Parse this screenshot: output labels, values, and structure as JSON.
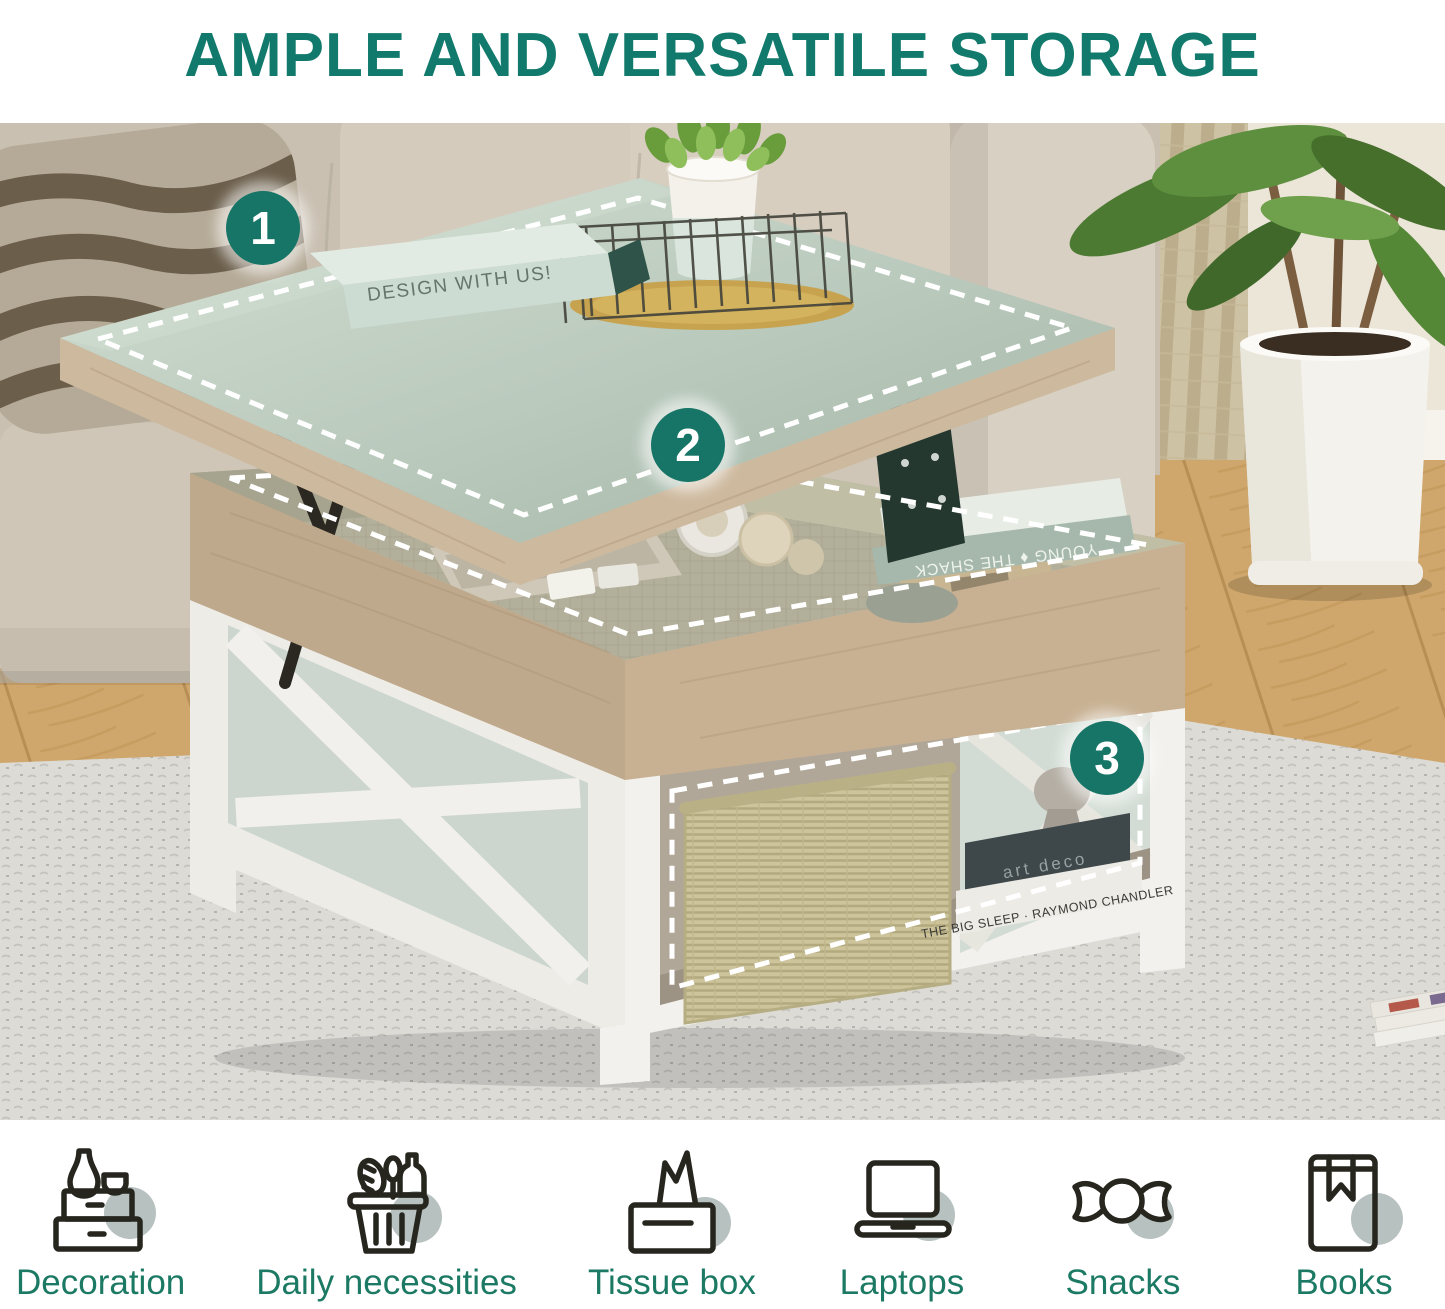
{
  "title": {
    "text": "AMPLE AND VERSATILE STORAGE"
  },
  "photo": {
    "badges": [
      {
        "number": "1"
      },
      {
        "number": "2"
      },
      {
        "number": "3"
      }
    ],
    "tabletop_book_spine": "DESIGN WITH US!",
    "storage_book_spine": "YOUNG ♦ THE SHACK",
    "shelf_book_dark_spine": "art deco",
    "shelf_book_light_spine": "THE BIG SLEEP · RAYMOND CHANDLER"
  },
  "features": [
    {
      "label": "Decoration",
      "icon": "decoration-chest-icon"
    },
    {
      "label": "Daily necessities",
      "icon": "shopping-basket-icon"
    },
    {
      "label": "Tissue box",
      "icon": "tissue-box-icon"
    },
    {
      "label": "Laptops",
      "icon": "laptop-icon"
    },
    {
      "label": "Snacks",
      "icon": "candy-icon"
    },
    {
      "label": "Books",
      "icon": "book-icon"
    }
  ],
  "colors": {
    "title_teal": "#117a6c",
    "badge_teal": "#167566",
    "label_teal": "#1c7a64",
    "icon_circle_gray": "#b7c1bf",
    "icon_stroke": "#26261f",
    "dashed_outline": "#ffffff"
  }
}
